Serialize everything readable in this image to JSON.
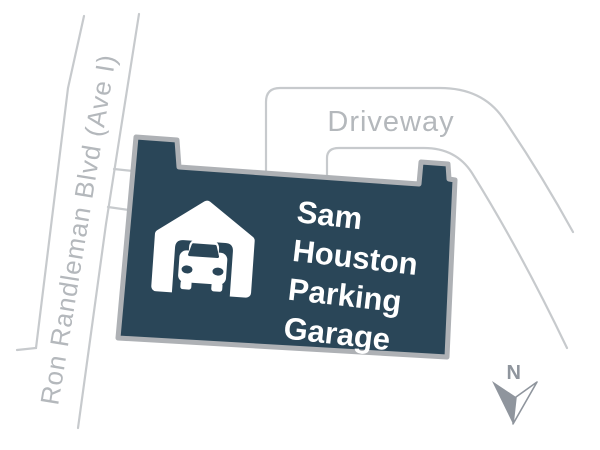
{
  "map": {
    "background_color": "#ffffff",
    "roads": {
      "line_color": "#c7cacd",
      "label_color": "#b4b8bc",
      "main_road": {
        "label": "Ron Randleman Blvd (Ave I)"
      },
      "driveway": {
        "label": "Driveway"
      }
    },
    "building": {
      "name": "Sam Houston Parking Garage",
      "label_lines": [
        "Sam",
        "Houston",
        "Parking",
        "Garage"
      ],
      "fill_color": "#2a4658",
      "border_color": "#aeb1b5",
      "text_color": "#ffffff",
      "icon": "garage-car-icon"
    },
    "compass": {
      "label": "N",
      "color": "#8f959d",
      "icon": "north-arrow-icon"
    }
  }
}
